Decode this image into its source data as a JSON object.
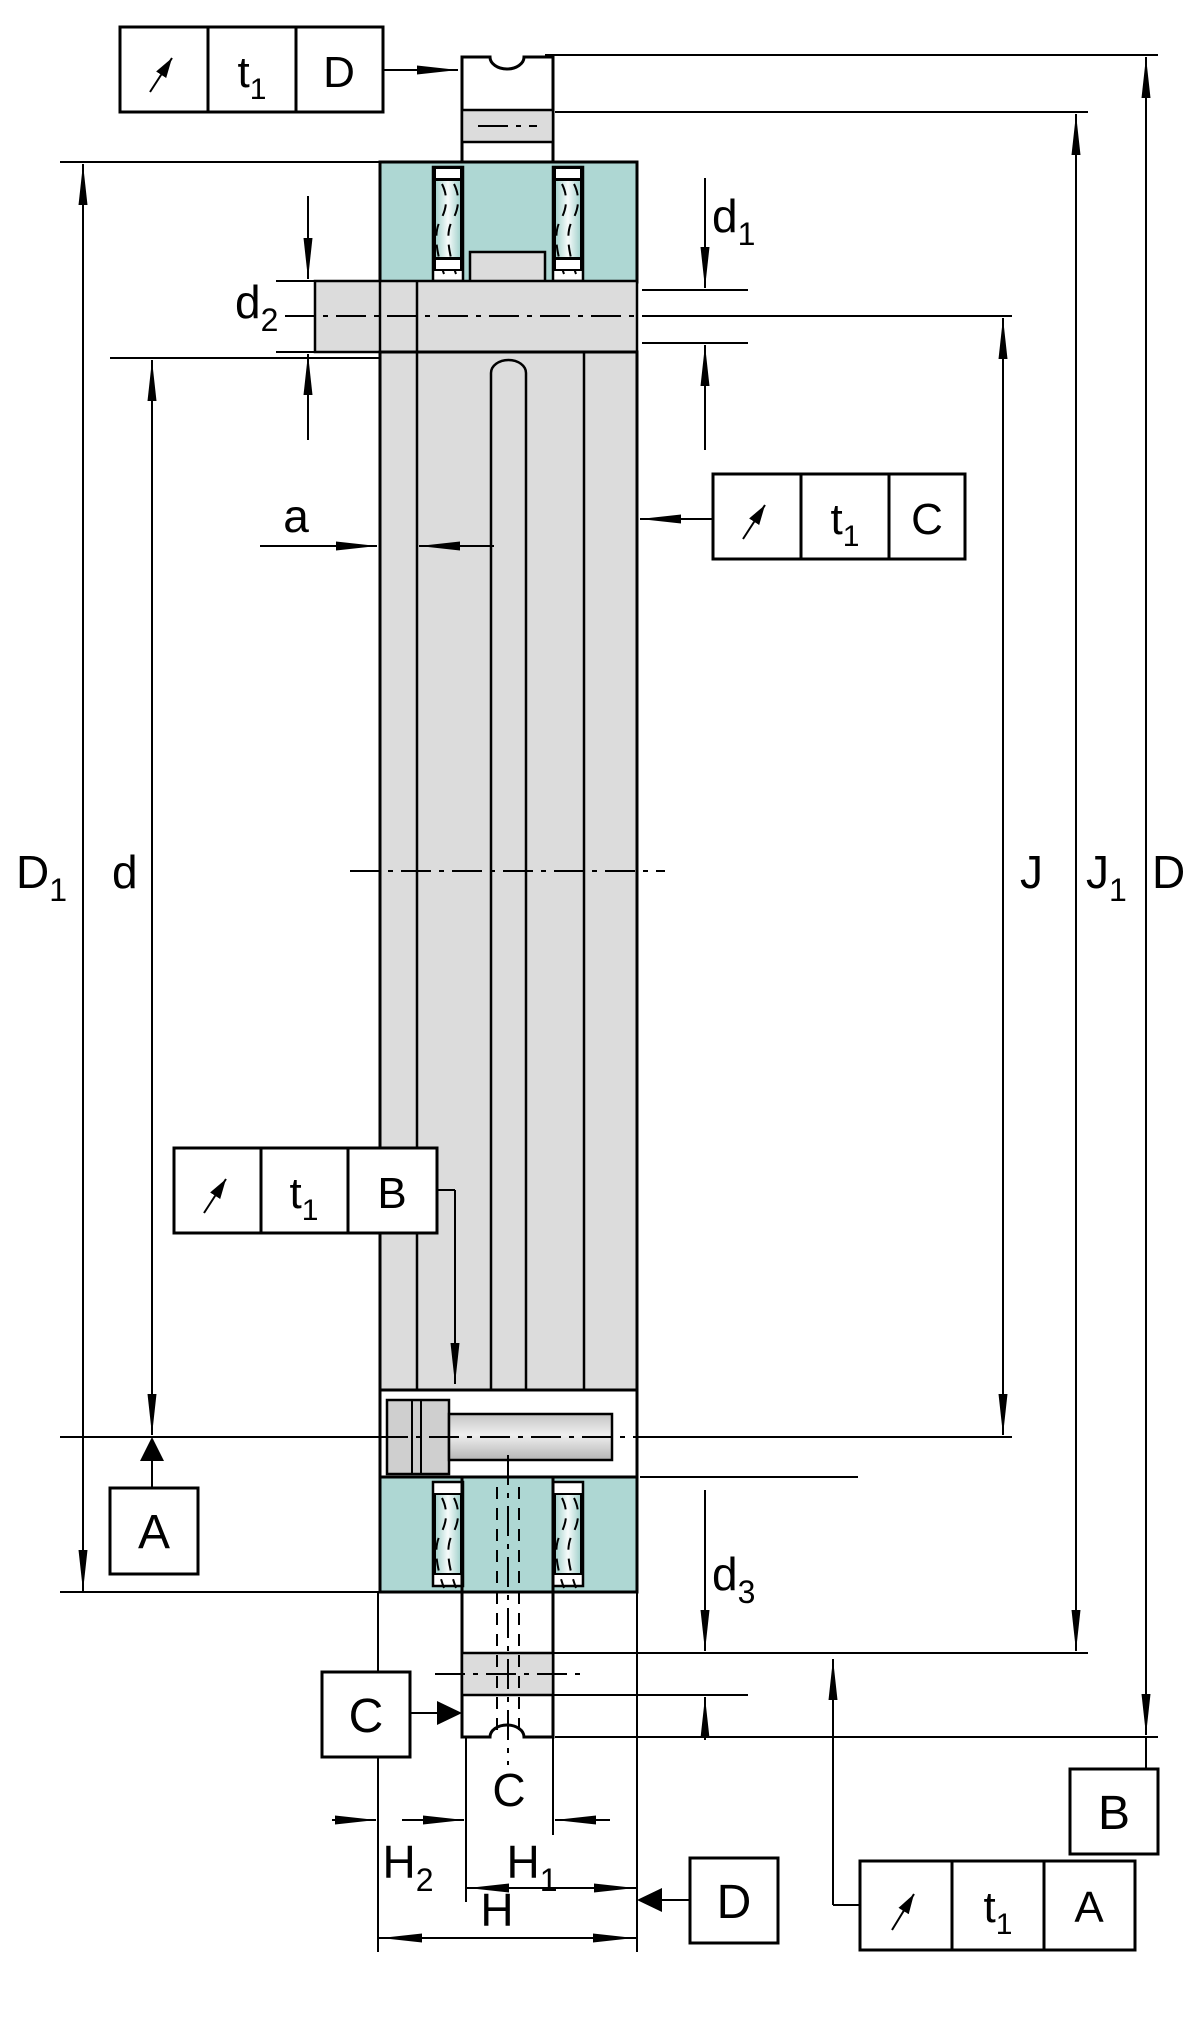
{
  "drawing": {
    "title": "Axial-radial bearing cross-section dimensional drawing",
    "colors": {
      "part_teal": "#aed7d3",
      "part_gray": "#dcdcdc",
      "roller_light": "#f3faf9",
      "bolt_gray": "#d6d6d6",
      "line": "#000000",
      "background": "#ffffff"
    },
    "dims": {
      "D1": {
        "base": "D",
        "sub": "1"
      },
      "d": {
        "base": "d",
        "sub": ""
      },
      "d1": {
        "base": "d",
        "sub": "1"
      },
      "d2": {
        "base": "d",
        "sub": "2"
      },
      "d3": {
        "base": "d",
        "sub": "3"
      },
      "a": {
        "base": "a",
        "sub": ""
      },
      "J": {
        "base": "J",
        "sub": ""
      },
      "J1": {
        "base": "J",
        "sub": "1"
      },
      "D": {
        "base": "D",
        "sub": ""
      },
      "C": {
        "base": "C",
        "sub": ""
      },
      "H": {
        "base": "H",
        "sub": ""
      },
      "H1": {
        "base": "H",
        "sub": "1"
      },
      "H2": {
        "base": "H",
        "sub": "2"
      }
    },
    "fcf": {
      "tolerance": {
        "base": "t",
        "sub": "1"
      },
      "top": {
        "symbol": "circular-runout",
        "datum": "D"
      },
      "right": {
        "symbol": "circular-runout",
        "datum": "C"
      },
      "left": {
        "symbol": "circular-runout",
        "datum": "B"
      },
      "bottom": {
        "symbol": "circular-runout",
        "datum": "A"
      }
    },
    "datums": {
      "A": "A",
      "B": "B",
      "C": "C",
      "D": "D"
    }
  }
}
